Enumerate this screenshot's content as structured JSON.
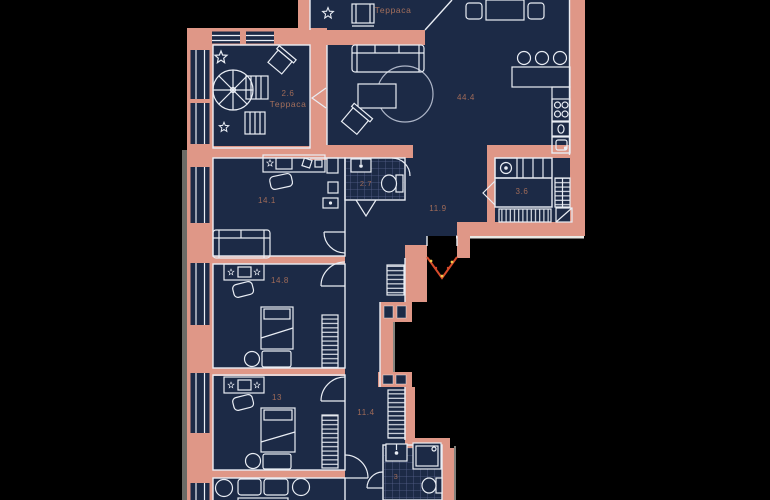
{
  "plan": {
    "type": "apartment-floor-plan",
    "language": "ru"
  },
  "colors": {
    "outside": "#000000",
    "floor": "#1c2a46",
    "wall": "#df9787",
    "linework": "#e9edf4",
    "tile_line": "#57628b",
    "label": "#a06b58",
    "entrance_door": "#d84b2b",
    "entrance_dots": "#f0c64a",
    "outer_edge": "#d6d2a0"
  },
  "rooms": {
    "terrace_top": {
      "label": "Терраса"
    },
    "terrace_left": {
      "area": "2.6",
      "label": "Терраса"
    },
    "living": {
      "area": "44.4"
    },
    "office": {
      "area": "14.1"
    },
    "bathroom_top": {
      "area": "2.7"
    },
    "hall_top": {
      "area": "11.9"
    },
    "storage": {
      "area": "3.6"
    },
    "bedroom_mid": {
      "area": "14.8"
    },
    "bedroom_low": {
      "area": "13"
    },
    "hall_low": {
      "area": "11.4"
    },
    "bathroom_low": {
      "area": "3"
    }
  }
}
